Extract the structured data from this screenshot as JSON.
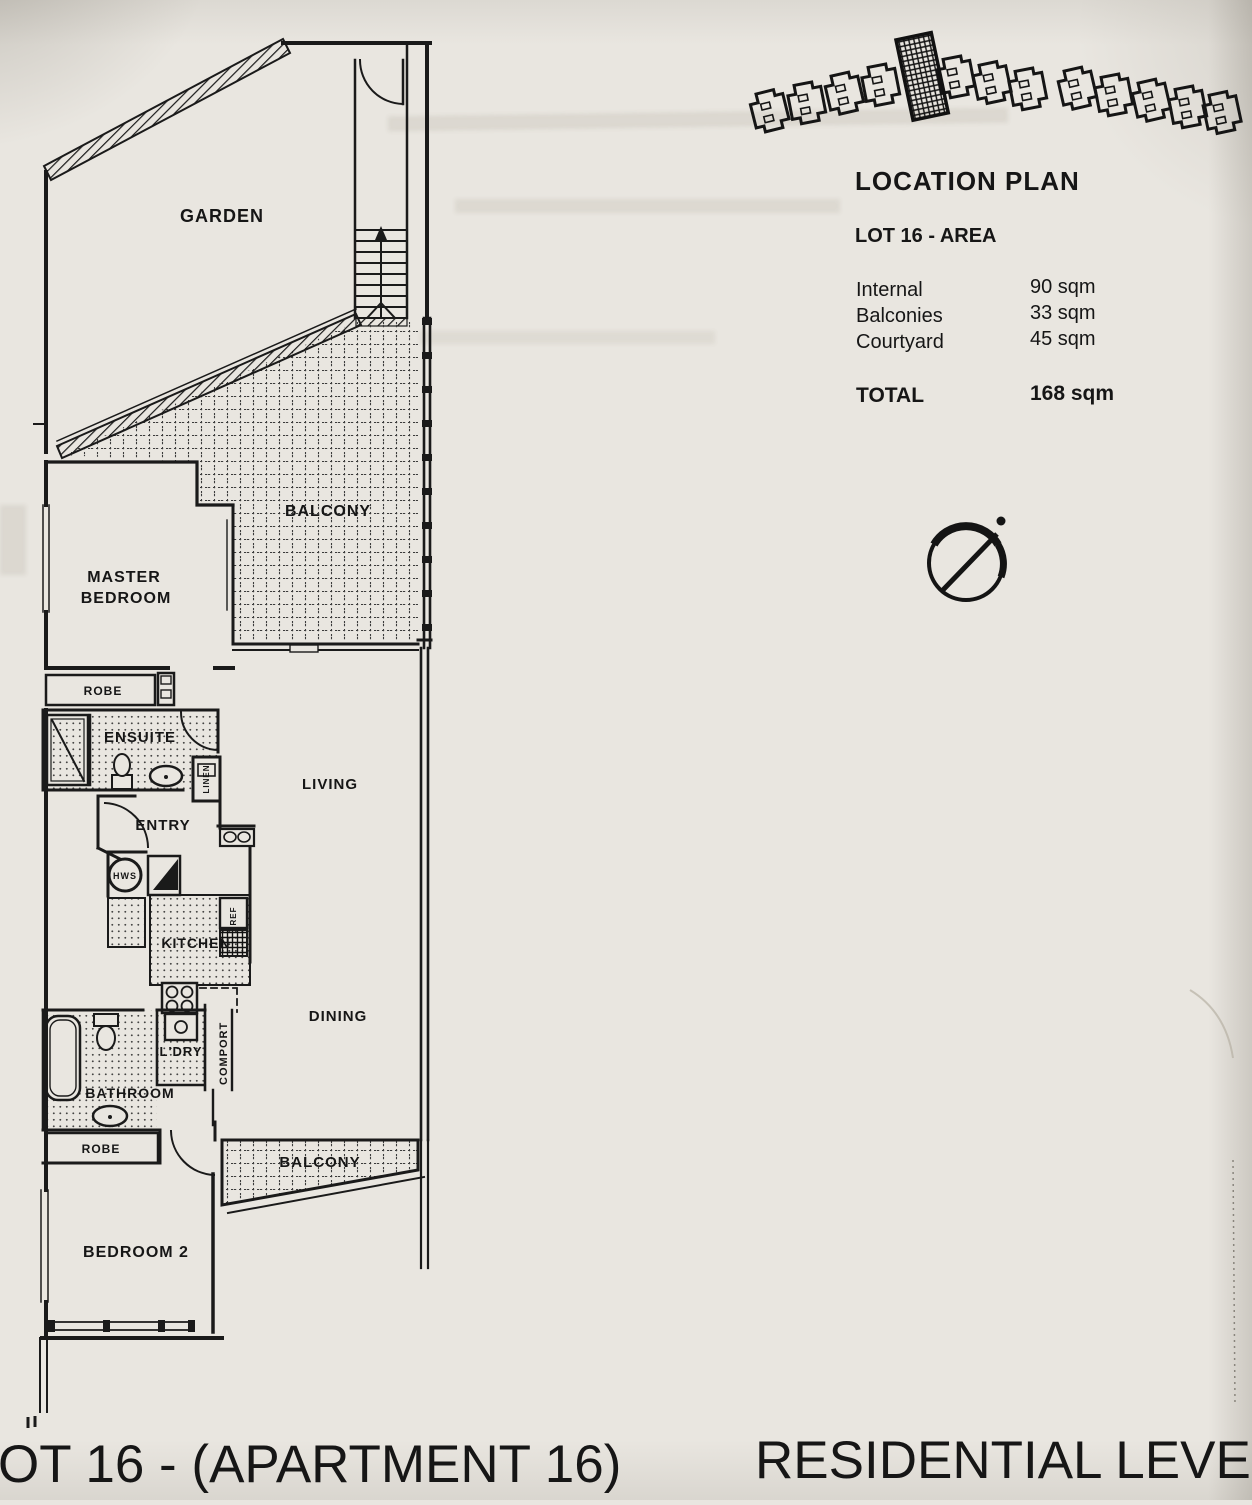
{
  "paper_color": "#e9e6e0",
  "ink_color": "#1a1a1a",
  "floor_plan": {
    "rooms": {
      "garden": "GARDEN",
      "balcony_upper": "BALCONY",
      "master_line1": "MASTER",
      "master_line2": "BEDROOM",
      "robe_master": "ROBE",
      "ensuite": "ENSUITE",
      "linen": "LINEN",
      "entry": "ENTRY",
      "living": "LIVING",
      "hws": "HWS",
      "kitchen": "KITCHEN",
      "ref": "REF",
      "dining": "DINING",
      "laundry": "L'DRY",
      "comport": "COMPORT",
      "bathroom": "BATHROOM",
      "robe_2": "ROBE",
      "balcony_lower": "BALCONY",
      "bedroom2": "BEDROOM 2"
    }
  },
  "info_panel": {
    "heading": "LOCATION PLAN",
    "subheading": "LOT 16 - AREA",
    "area_rows": [
      {
        "label": "Internal",
        "value": "90 sqm"
      },
      {
        "label": "Balconies",
        "value": "33 sqm"
      },
      {
        "label": "Courtyard",
        "value": "45 sqm"
      }
    ],
    "total_label": "TOTAL",
    "total_value": "168 sqm"
  },
  "footer": {
    "left_caption": "OT 16 - (APARTMENT 16)",
    "right_caption": "RESIDENTIAL LEVEL O"
  }
}
